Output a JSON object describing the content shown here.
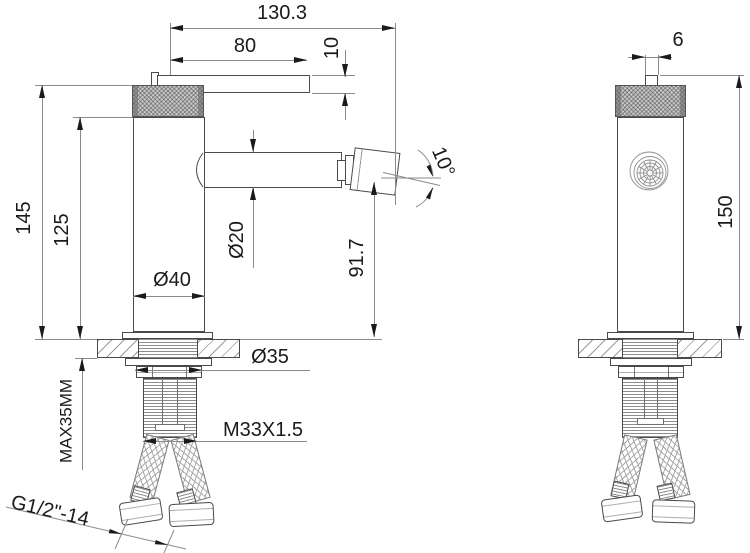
{
  "drawing": {
    "title": "Faucet two-view installation dimension drawing",
    "views": [
      {
        "name": "side view"
      },
      {
        "name": "front view"
      }
    ]
  },
  "colors": {
    "line": "#4a4a4a",
    "dim_line": "#8a8a8a",
    "text": "#1a1a1a",
    "knurl_fill": "#c9c9c9"
  },
  "dims": {
    "overall_reach": "130.3",
    "handle_length": "80",
    "handle_thickness": "10",
    "height_to_cap": "145",
    "height_to_body_top": "125",
    "body_diameter": "Ø40",
    "spout_diameter": "Ø20",
    "spout_height": "91.7",
    "aerator_angle": "10°",
    "hole_diameter": "Ø35",
    "max_deck_thickness": "MAX35MM",
    "shank_thread": "M33X1.5",
    "hose_thread": "G1/2\"-14",
    "handle_width": "6",
    "total_height": "150"
  }
}
